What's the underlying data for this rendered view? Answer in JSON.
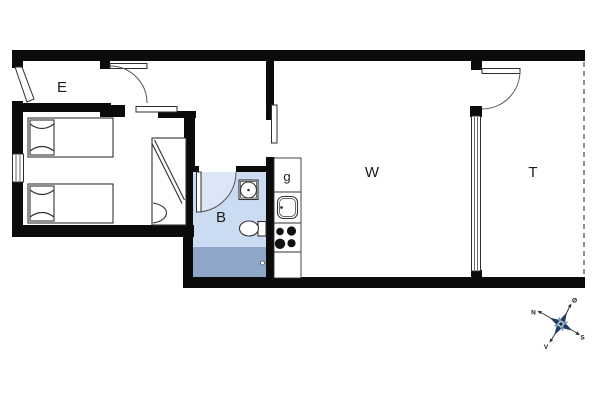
{
  "plan": {
    "rooms": {
      "entry": {
        "label": "E"
      },
      "bathroom": {
        "label": "B"
      },
      "kitchen_cabinet": {
        "label": "g"
      },
      "living_room": {
        "label": "W"
      },
      "terrace": {
        "label": "T"
      }
    },
    "colors": {
      "wall": "#0b0b0b",
      "bathroom_floor": "#cbdcf2",
      "shower_floor": "#8fa6c8"
    }
  },
  "compass": {
    "north_label": "N",
    "east_label": "Ø",
    "south_label": "S",
    "west_label": "V",
    "rose_color": "#1d3a5f",
    "rose_secondary": "#7d97b8"
  }
}
